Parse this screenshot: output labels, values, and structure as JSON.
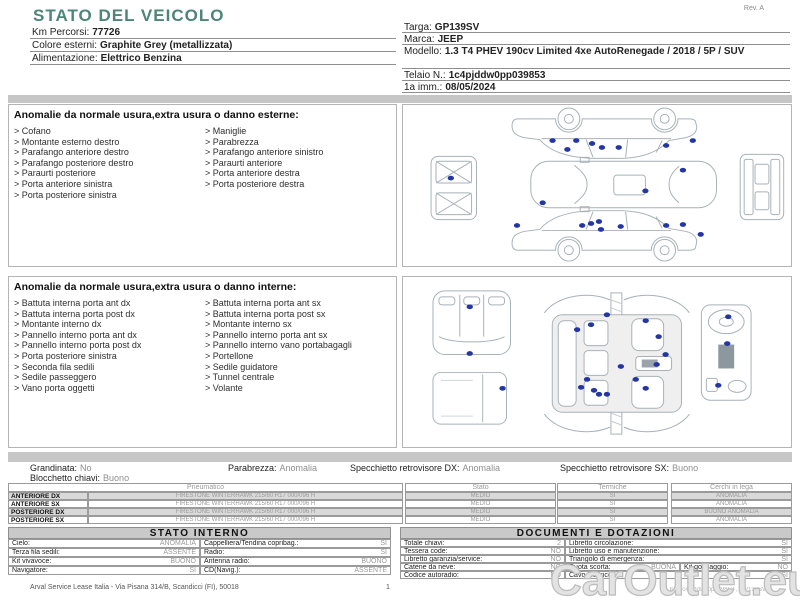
{
  "colors": {
    "accent_teal": "#4d8577",
    "damage_dot": "#2336a4",
    "stripe_gray": "#d9d9d9",
    "bar_gray": "#c6c6c6"
  },
  "page": {
    "title": "STATO DEL VEICOLO",
    "rev": "Rev. A",
    "watermark": "CarOutlet.eu"
  },
  "vehicle_info_left": [
    {
      "label": "Km Percorsi:",
      "value": "77726"
    },
    {
      "label": "Colore esterni:",
      "value": "Graphite Grey (metallizzata)"
    },
    {
      "label": "Alimentazione:",
      "value": "Elettrico Benzina"
    }
  ],
  "vehicle_info_right": [
    {
      "label": "Targa:",
      "value": "GP139SV"
    },
    {
      "label": "Marca:",
      "value": "JEEP"
    },
    {
      "label": "Modello:",
      "value": "1.3 T4 PHEV 190cv Limited 4xe AutoRenegade / 2018 / 5P / SUV"
    },
    {
      "label": "Telaio N.:",
      "value": "1c4pjddw0pp039853"
    },
    {
      "label": "1a imm.:",
      "value": "08/05/2024"
    }
  ],
  "exterior": {
    "header": "Anomalie da normale usura,extra usura o danno esterne:",
    "col1": [
      "Cofano",
      "Montante esterno destro",
      "Parafango anteriore destro",
      "Parafango posteriore destro",
      "Paraurti posteriore",
      "Porta anteriore sinistra",
      "Porta posteriore sinistra"
    ],
    "col2": [
      "Maniglie",
      "Parabrezza",
      "Parafango anteriore sinistro",
      "Paraurti anteriore",
      "Porta anteriore destra",
      "Porta posteriore destra"
    ]
  },
  "interior": {
    "header": "Anomalie da normale usura,extra usura o danno interne:",
    "col1": [
      "Battuta interna porta ant dx",
      "Battuta interna porta post dx",
      "Montante interno dx",
      "Pannello interno porta ant dx",
      "Pannello interno porta post dx",
      "Porta posteriore sinistra",
      "Seconda fila sedili",
      "Sedile passeggero",
      "Vano porta oggetti"
    ],
    "col2": [
      "Battuta interna porta ant sx",
      "Battuta interna porta post sx",
      "Montante interno sx",
      "Pannello interno porta ant sx",
      "Pannello interno vano portabagagli",
      "Portellone",
      "Sedile guidatore",
      "Tunnel centrale",
      "Volante"
    ]
  },
  "summary": {
    "items": [
      {
        "label": "Grandinata:",
        "value": "No"
      },
      {
        "label": "Parabrezza:",
        "value": "Anomalia"
      },
      {
        "label": "Specchietto retrovisore DX:",
        "value": "Anomalia"
      },
      {
        "label": "Specchietto retrovisore SX:",
        "value": "Buono"
      },
      {
        "label": "Blocchetto chiavi:",
        "value": "Buono"
      }
    ]
  },
  "tyres": {
    "headers": [
      "Pneumatico",
      "Stato",
      "Termiche",
      "Cerchi in lega"
    ],
    "rows": [
      {
        "position": "ANTERIORE DX",
        "tyre": "FIRESTONE WINTERHAWK  215/60 R17 000/096 H",
        "stato": "MEDIO",
        "termiche": "SI",
        "cerchi": "ANOMALIA"
      },
      {
        "position": "ANTERIORE SX",
        "tyre": "FIRESTONE WINTERHAWK  215/60 R17 000/096 H",
        "stato": "MEDIO",
        "termiche": "SI",
        "cerchi": "ANOMALIA"
      },
      {
        "position": "POSTERIORE DX",
        "tyre": "FIRESTONE WINTERHAWK  215/60 R17 000/096 H",
        "stato": "MEDIO",
        "termiche": "SI",
        "cerchi": "BUONO ANOMALIA"
      },
      {
        "position": "POSTERIORE SX",
        "tyre": "FIRESTONE WINTERHAWK  215/60 R17 000/096 H",
        "stato": "MEDIO",
        "termiche": "SI",
        "cerchi": "ANOMALIA"
      }
    ]
  },
  "stato_interno": {
    "title": "STATO INTERNO",
    "rows": [
      {
        "l1": "Cielo:",
        "v1": "ANOMALIA",
        "l2": "Cappelliera/Tendina copribag.:",
        "v2": "SI"
      },
      {
        "l1": "Terza fila sedili:",
        "v1": "ASSENTE",
        "l2": "Radio:",
        "v2": "SI"
      },
      {
        "l1": "Kit vivavoce:",
        "v1": "BUONO",
        "l2": "Antenna radio:",
        "v2": "BUONO"
      },
      {
        "l1": "Navigatore:",
        "v1": "SI",
        "l2": "CD(Navig.):",
        "v2": "ASSENTE"
      }
    ]
  },
  "documenti": {
    "title": "DOCUMENTI E DOTAZIONI",
    "rows": [
      {
        "l1": "Totale chiavi:",
        "v1": "2",
        "l2": "Libretto circolazione:",
        "v2": "SI"
      },
      {
        "l1": "Tessera code:",
        "v1": "NO",
        "l2": "Libretto uso e manutenzione:",
        "v2": "SI"
      },
      {
        "l1": "Libretto garanzia/service:",
        "v1": "NO",
        "l2": "Triangolo di emergenza:",
        "v2": "SI"
      },
      {
        "l1": "Catene da neve:",
        "v1": "NO",
        "l2": "Ruota scorta:",
        "v2": "BUONA",
        "l3": "Kit gonfiaggio:",
        "v3": "NO"
      },
      {
        "l1": "Codice autoradio:",
        "v1": "NO",
        "l2": "Cavo elettrico:",
        "v2": "SI"
      }
    ]
  },
  "footer": {
    "company": "Arval Service Lease Italia - Via Pisana 314/B, Scandicci (FI), 50018",
    "page": "1",
    "right_text": "ID: 1c4pjddw0pp039853 , GP139SV"
  },
  "diagrams": [
    {
      "target": "exterior-damage-svg",
      "dots": [
        [
          150,
          36
        ],
        [
          174,
          36
        ],
        [
          190,
          39
        ],
        [
          200,
          43
        ],
        [
          217,
          43
        ],
        [
          265,
          41
        ],
        [
          292,
          36
        ],
        [
          165,
          45
        ],
        [
          282,
          66
        ],
        [
          244,
          87
        ],
        [
          140,
          99
        ],
        [
          47,
          74
        ],
        [
          114,
          122
        ],
        [
          180,
          122
        ],
        [
          189,
          120
        ],
        [
          197,
          118
        ],
        [
          199,
          126
        ],
        [
          219,
          123
        ],
        [
          265,
          122
        ],
        [
          282,
          121
        ],
        [
          300,
          131
        ]
      ]
    },
    {
      "target": "interior-damage-svg",
      "dots": [
        [
          67,
          30
        ],
        [
          67,
          77
        ],
        [
          100,
          112
        ],
        [
          205,
          38
        ],
        [
          189,
          48
        ],
        [
          175,
          53
        ],
        [
          244,
          44
        ],
        [
          257,
          60
        ],
        [
          264,
          78
        ],
        [
          255,
          88
        ],
        [
          219,
          90
        ],
        [
          234,
          103
        ],
        [
          185,
          103
        ],
        [
          179,
          111
        ],
        [
          192,
          114
        ],
        [
          197,
          118
        ],
        [
          244,
          112
        ],
        [
          205,
          118
        ],
        [
          327,
          40
        ],
        [
          326,
          67
        ],
        [
          317,
          109
        ]
      ]
    }
  ]
}
